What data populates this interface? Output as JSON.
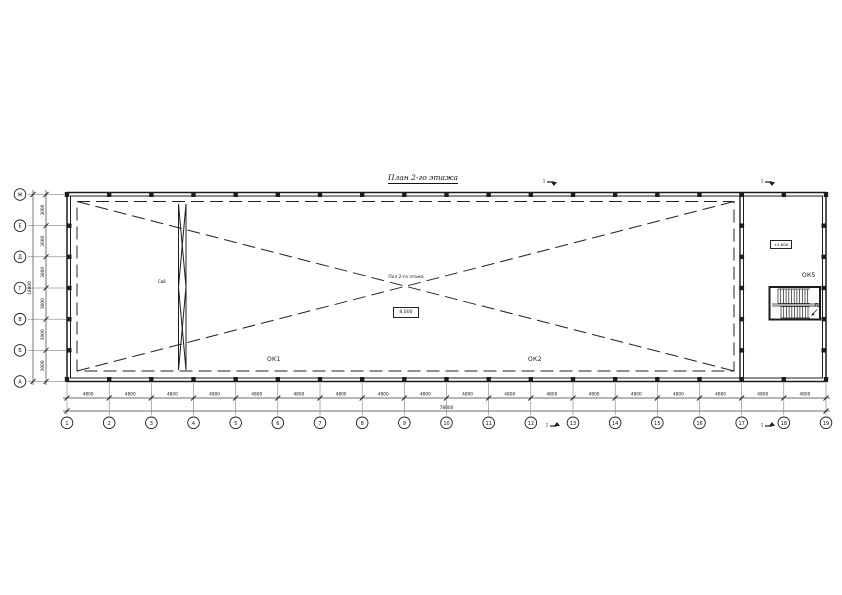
{
  "title": "План 2-го этажа",
  "axes": {
    "bottom": {
      "numbers": [
        "1",
        "2",
        "3",
        "4",
        "5",
        "6",
        "7",
        "8",
        "9",
        "10",
        "11",
        "12",
        "13",
        "14",
        "15",
        "16",
        "17",
        "18",
        "19"
      ],
      "bay_dims": [
        "4800",
        "4800",
        "4800",
        "4800",
        "4800",
        "4800",
        "4800",
        "4800",
        "4800",
        "4800",
        "4800",
        "4800",
        "4800",
        "4800",
        "4800",
        "4800",
        "4800",
        "4800"
      ],
      "total": "78000"
    },
    "left": {
      "letters": [
        "А",
        "Б",
        "В",
        "Г",
        "Д",
        "Е",
        "Ж"
      ],
      "row_dims": [
        "3000",
        "3000",
        "3000",
        "3000",
        "3000",
        "3000"
      ],
      "total": "18000"
    }
  },
  "annotations": {
    "ok1": "ОК1",
    "ok2": "ОК2",
    "ok5": "ОК5",
    "stair_label": "Л2",
    "bracing_label": "Св8",
    "center_note": "Пол 2-го этажа",
    "center_elevation": "8.000",
    "stair_elevation": "+4.800",
    "section_mark": "1"
  },
  "colors": {
    "line": "#1c1c1c",
    "dim": "#3c3c3c",
    "text": "#111111"
  }
}
